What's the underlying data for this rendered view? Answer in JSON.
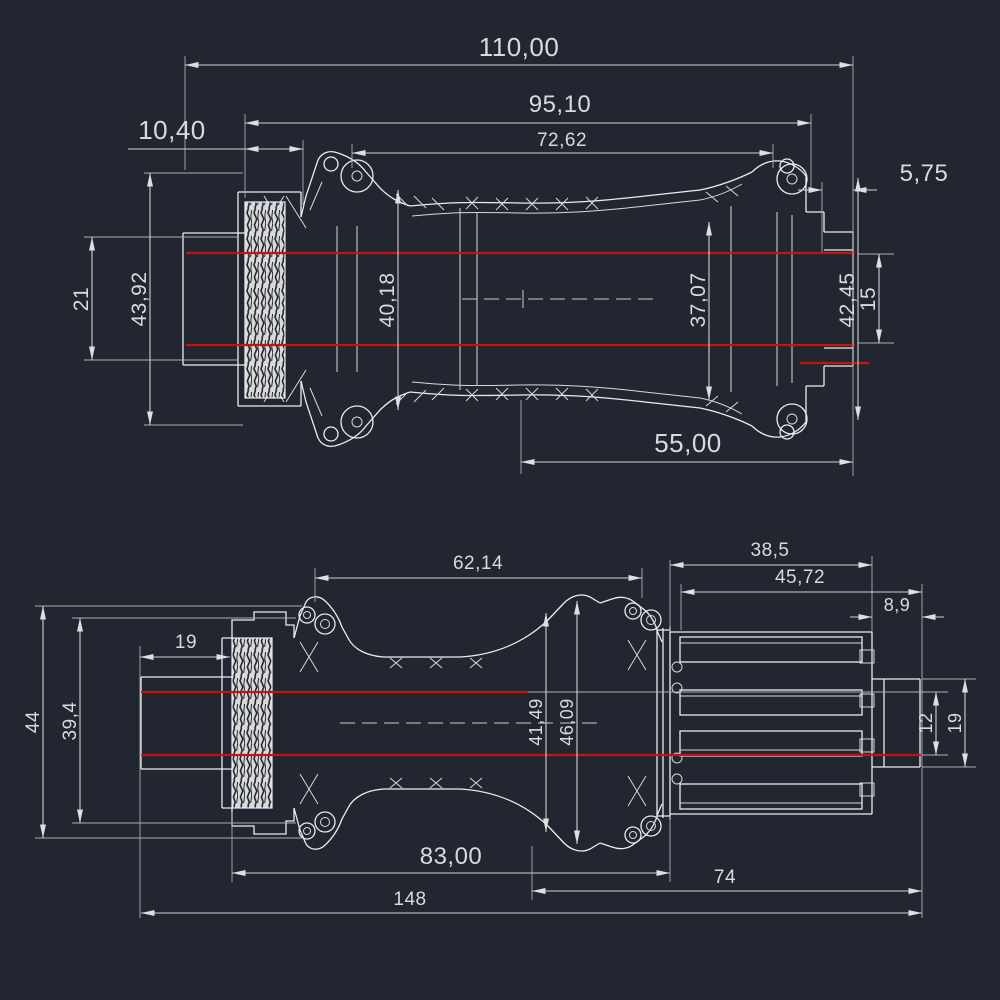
{
  "colors": {
    "background": "#222631",
    "geometry_line": "#ececec",
    "centerline_red": "#c11414",
    "dimension_line": "#cdd0d4",
    "text": "#d9dadc",
    "knurl_fill": "#d9d9d9"
  },
  "top_view": {
    "dimensions": {
      "overall_width": "110,00",
      "body_width": "95,10",
      "flange_spacing": "72,62",
      "left_end": "10,40",
      "right_end": "5,75",
      "center_to_right": "55,00",
      "left_axle_dia": "21",
      "left_cap_dia": "43,92",
      "left_shell_dia": "40,18",
      "right_shell_dia": "37,07",
      "right_cap_dia": "42,45",
      "right_axle_dia": "15"
    }
  },
  "bottom_view": {
    "dimensions": {
      "flange_spacing": "62,14",
      "freehub_len_a": "38,5",
      "freehub_len_b": "45,72",
      "end_cap_len": "8,9",
      "left_cap_len": "19",
      "left_dia_outer": "44",
      "left_dia_inner": "39,4",
      "shell_dia_a": "41,49",
      "shell_dia_b": "46,09",
      "axle_dia": "12",
      "right_cap_dia": "19",
      "body_len": "83,00",
      "right_len": "74",
      "overall_len": "148"
    }
  }
}
